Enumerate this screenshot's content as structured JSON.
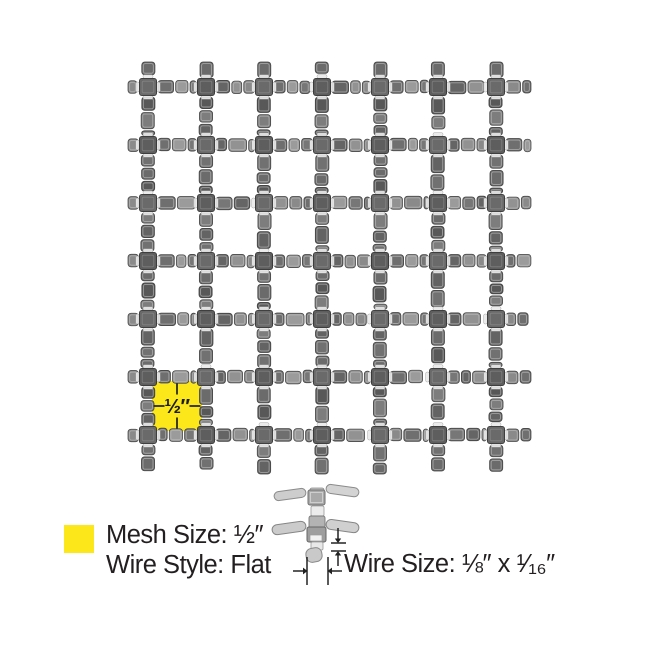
{
  "page": {
    "background": "#ffffff"
  },
  "mesh": {
    "grid": {
      "vertical_wires": 7,
      "horizontal_wires": 7
    },
    "highlight": {
      "label": "½″",
      "color": "#fbe71a"
    }
  },
  "legend": {
    "swatch_color": "#fbe71a",
    "mesh_size": {
      "label": "Mesh Size:",
      "value": "½″"
    },
    "wire_style": {
      "label": "Wire Style:",
      "value": "Flat"
    },
    "wire_size": {
      "label": "Wire Size:",
      "value": "⅛″ x ¹⁄₁₆″"
    }
  }
}
